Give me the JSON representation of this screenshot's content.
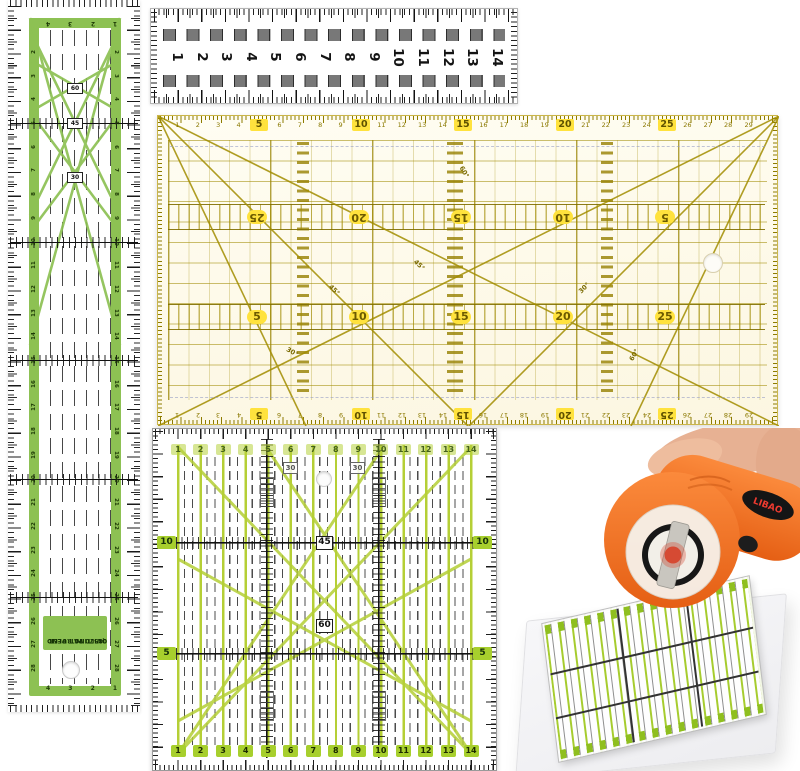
{
  "stage": {
    "alt": "Quilting ruler set with green strip ruler, clear ruler, large yellow grid ruler, square grid ruler and orange rotary cutter"
  },
  "strip_ruler": {
    "label_line1": "QUILTING RULER",
    "label_line2": "08570  PAT. PEND",
    "length_numbers": [
      2,
      3,
      4,
      5,
      6,
      7,
      8,
      9,
      10,
      11,
      12,
      13,
      14,
      15,
      16,
      17,
      18,
      19,
      20,
      21,
      22,
      23,
      24,
      25,
      26,
      27,
      28
    ],
    "cross_rows": [
      5,
      10,
      15,
      20,
      25
    ],
    "width_numbers": [
      1,
      2,
      3,
      4
    ],
    "angles": {
      "a60": "60",
      "a45": "45",
      "a30": "30"
    },
    "green": "#8dc153"
  },
  "top_ruler": {
    "numbers": [
      1,
      2,
      3,
      4,
      5,
      6,
      7,
      8,
      9,
      10,
      11,
      12,
      13,
      14
    ]
  },
  "big_ruler": {
    "edge_numbers": [
      1,
      2,
      3,
      4,
      5,
      6,
      7,
      8,
      9,
      10,
      11,
      12,
      13,
      14,
      15,
      16,
      17,
      18,
      19,
      20,
      21,
      22,
      23,
      24,
      25,
      26,
      27,
      28,
      29
    ],
    "bold_numbers": [
      5,
      10,
      15,
      20,
      25
    ],
    "upper_band_numbers": [
      25,
      20,
      15,
      10,
      5
    ],
    "lower_band_numbers": [
      5,
      10,
      15,
      20,
      25
    ],
    "angles": {
      "a30": "30°",
      "a45": "45°",
      "a60": "60°"
    },
    "accent": "#ffe23d",
    "line": "#a89200"
  },
  "square_ruler": {
    "numbers": [
      1,
      2,
      3,
      4,
      5,
      6,
      7,
      8,
      9,
      10,
      11,
      12,
      13,
      14
    ],
    "side_left": [
      "10",
      "5"
    ],
    "side_right": [
      "10",
      "5"
    ],
    "angles": {
      "a30": "30",
      "a45": "45",
      "a60": "60"
    },
    "green": "#b5cf36"
  },
  "cutter": {
    "brand": "LIBAO",
    "body_color": "#f2731f"
  }
}
